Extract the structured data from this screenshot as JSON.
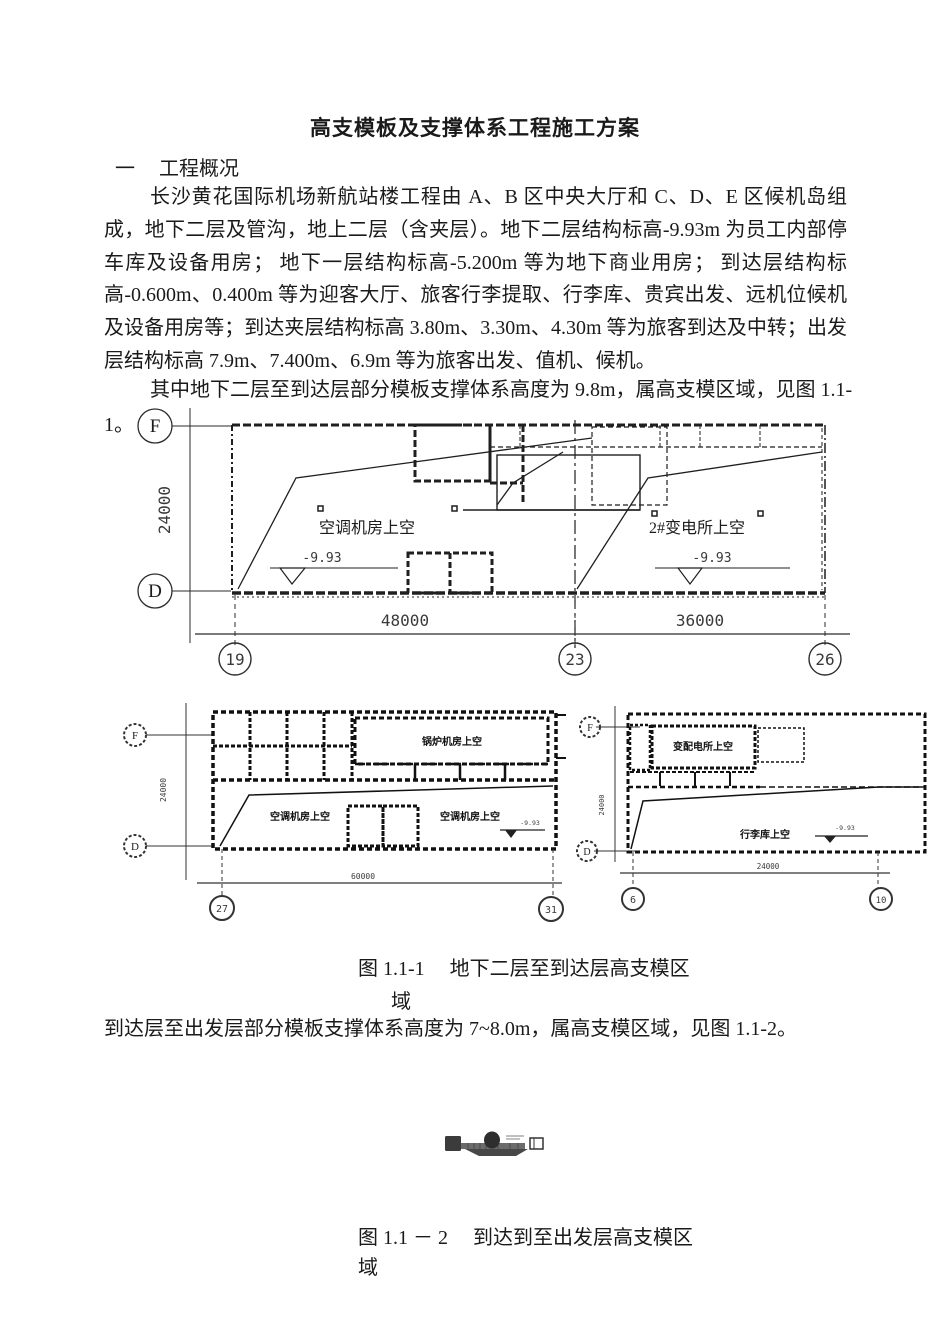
{
  "doc": {
    "title": "高支模板及支撑体系工程施工方案",
    "section_no": "一",
    "section_heading": "工程概况",
    "paragraph1": "长沙黄花国际机场新航站楼工程由 A、B 区中央大厅和 C、D、E 区候机岛组成，地下二层及管沟，地上二层（含夹层）。地下二层结构标高-9.93m 为员工内部停车库及设备用房； 地下一层结构标高-5.200m 等为地下商业用房； 到达层结构标高-0.600m、0.400m 等为迎客大厅、旅客行李提取、行李库、贵宾出发、远机位候机及设备用房等；到达夹层结构标高 3.80m、3.30m、4.30m 等为旅客到达及中转；出发层结构标高 7.9m、7.400m、6.9m 等为旅客出发、值机、候机。",
    "paragraph2": "其中地下二层至到达层部分模板支撑体系高度为 9.8m，属高支模区域，见图 1.1-",
    "paragraph2_wrap": "1。",
    "figure1_caption_line1": "图 1.1-1　 地下二层至到达层高支模区",
    "figure1_caption_line2": "域",
    "paragraph3": "到达层至出发层部分模板支撑体系高度为 7~8.0m，属高支模区域，见图 1.1-2。",
    "figure2_caption_line1": "图 1.1 － 2　 到达到至出发层高支模区",
    "figure2_caption_line2": "域"
  },
  "fig1": {
    "main": {
      "row_bubble_top": "F",
      "row_bubble_bottom": "D",
      "dim_height": "24000",
      "label_left_room": "空调机房上空",
      "label_right_room": "2#变电所上空",
      "elev_left": "-9.93",
      "elev_right": "-9.93",
      "dim_span_left": "48000",
      "dim_span_right": "36000",
      "col_bubbles": [
        "19",
        "23",
        "26"
      ]
    },
    "left": {
      "row_bubble_top": "F",
      "row_bubble_bottom": "D",
      "dim_height": "24000",
      "label_top_room": "锅炉机房上空",
      "label_bottom_left_room": "空调机房上空",
      "label_bottom_right_room": "空调机房上空",
      "elev": "-9.93",
      "dim_span": "60000",
      "col_bubble_left": "27",
      "col_bubble_right": "31"
    },
    "right": {
      "row_bubble_top": "F",
      "row_bubble_bottom": "D",
      "dim_height": "24000",
      "label_top_room": "变配电所上空",
      "label_bottom_room": "行李库上空",
      "elev": "-9.93",
      "dim_span": "24000",
      "col_bubble_left": "6",
      "col_bubble_right": "10"
    }
  },
  "colors": {
    "ink": "#1a1a1a",
    "line": "#2b2b2b",
    "dim_text": "#3a3a3a",
    "faint_text": "#888888"
  }
}
